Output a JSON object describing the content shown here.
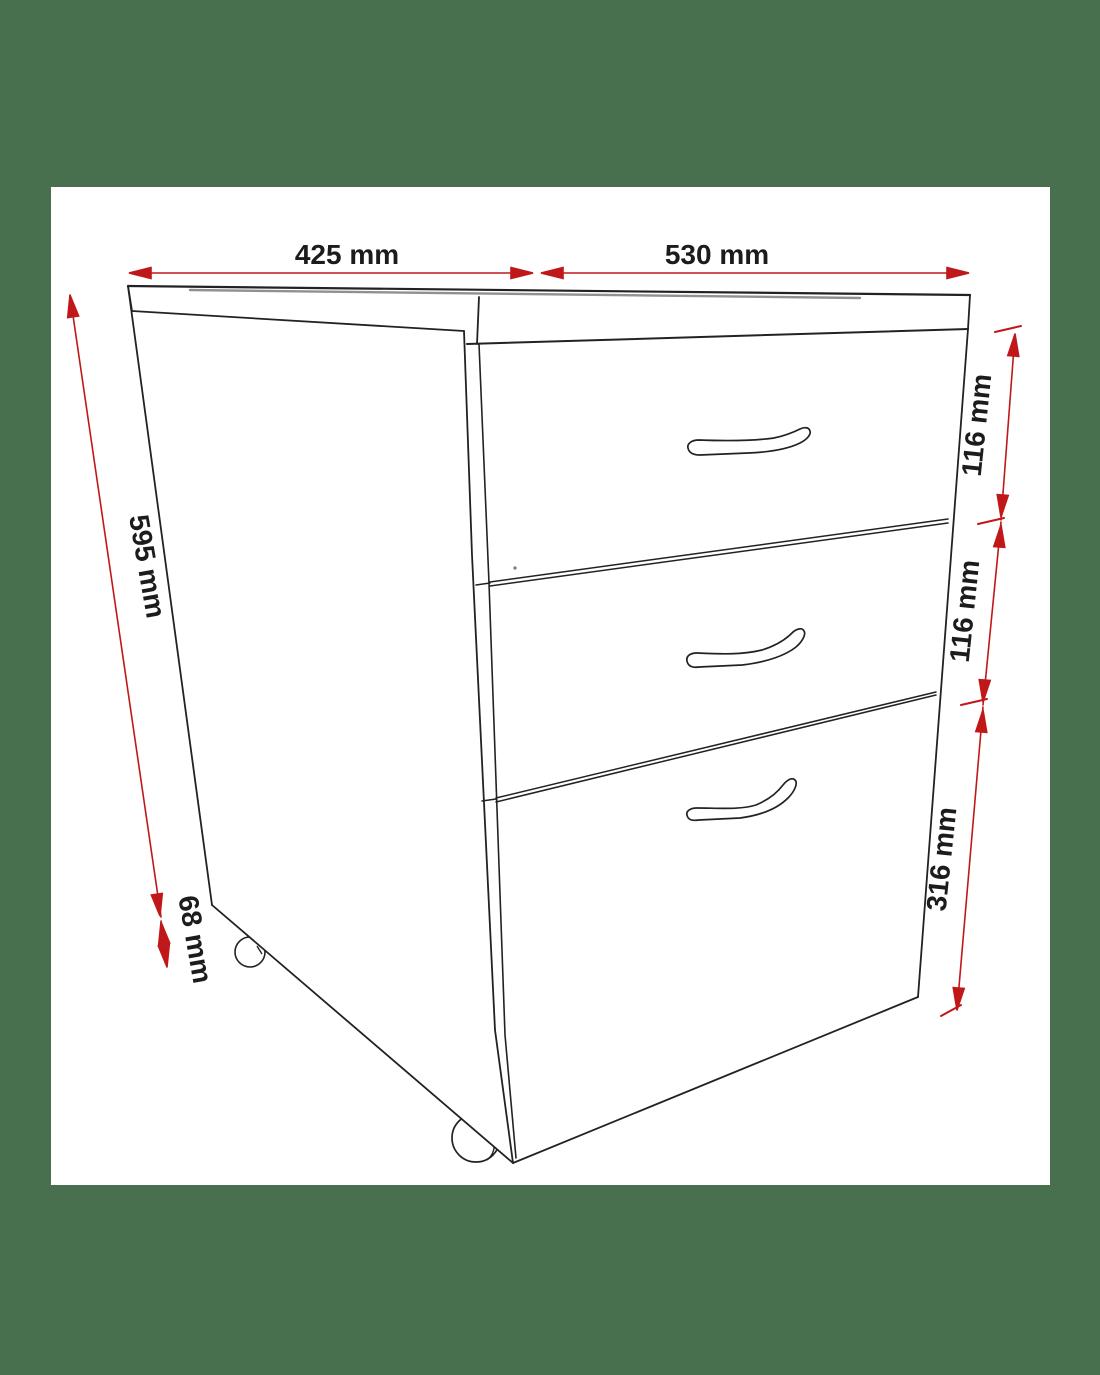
{
  "diagram": {
    "type": "furniture-dimension-drawing",
    "subject": "three-drawer mobile pedestal cabinet with two casters and three curved handles",
    "drawer_count": 3,
    "handle_count": 3,
    "caster_count": 2
  },
  "colors": {
    "background_green": "#48704e",
    "page_white": "#ffffff",
    "line_black": "#222222",
    "edge_gray": "#909090",
    "dimension_red": "#c01818",
    "label_black": "#1c1c1c"
  },
  "dimensions": {
    "depth_top_left": {
      "label": "425 mm"
    },
    "width_top_right": {
      "label": "530 mm"
    },
    "height_left": {
      "label": "595 mm"
    },
    "caster_height_left": {
      "label": "68 mm"
    },
    "drawer1_right": {
      "label": "116 mm"
    },
    "drawer2_right": {
      "label": "116 mm"
    },
    "drawer3_right": {
      "label": "316 mm"
    }
  }
}
